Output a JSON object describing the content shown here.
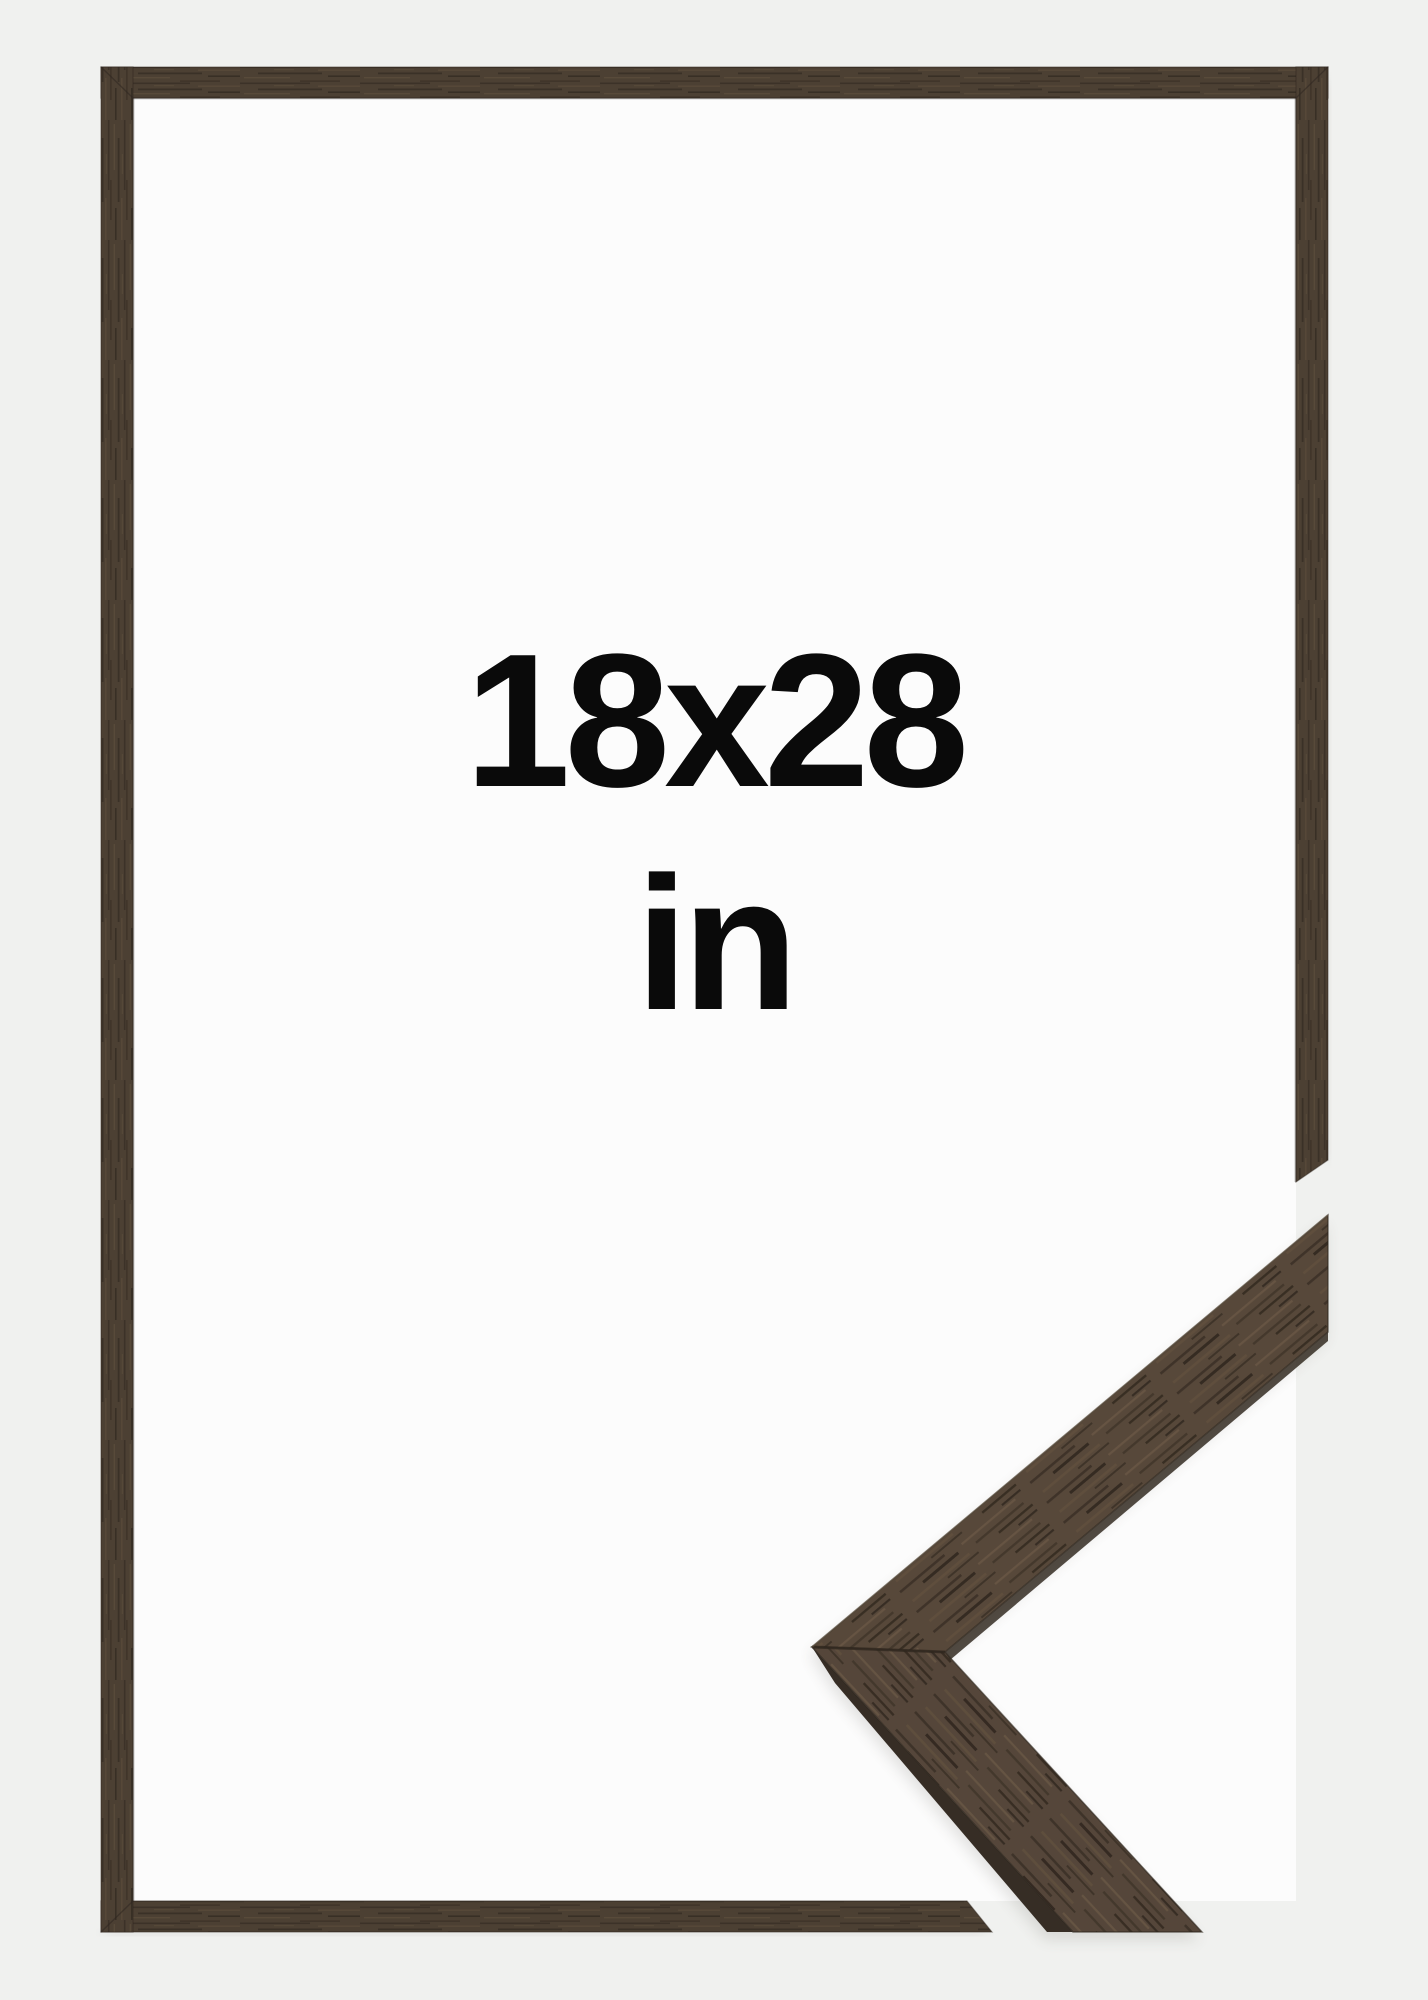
{
  "product_image": {
    "size_label": "18x28",
    "unit_label": "in",
    "colors": {
      "background": "#f0f1ef",
      "inside_frame": "#fcfcfc",
      "wood_base": "#4c4033",
      "wood_dark": "#352c23",
      "wood_light": "#5d4e3d",
      "sample_wood": "#57483a",
      "sample_side_face": "#362d25",
      "text": "#0a0a0a"
    }
  }
}
